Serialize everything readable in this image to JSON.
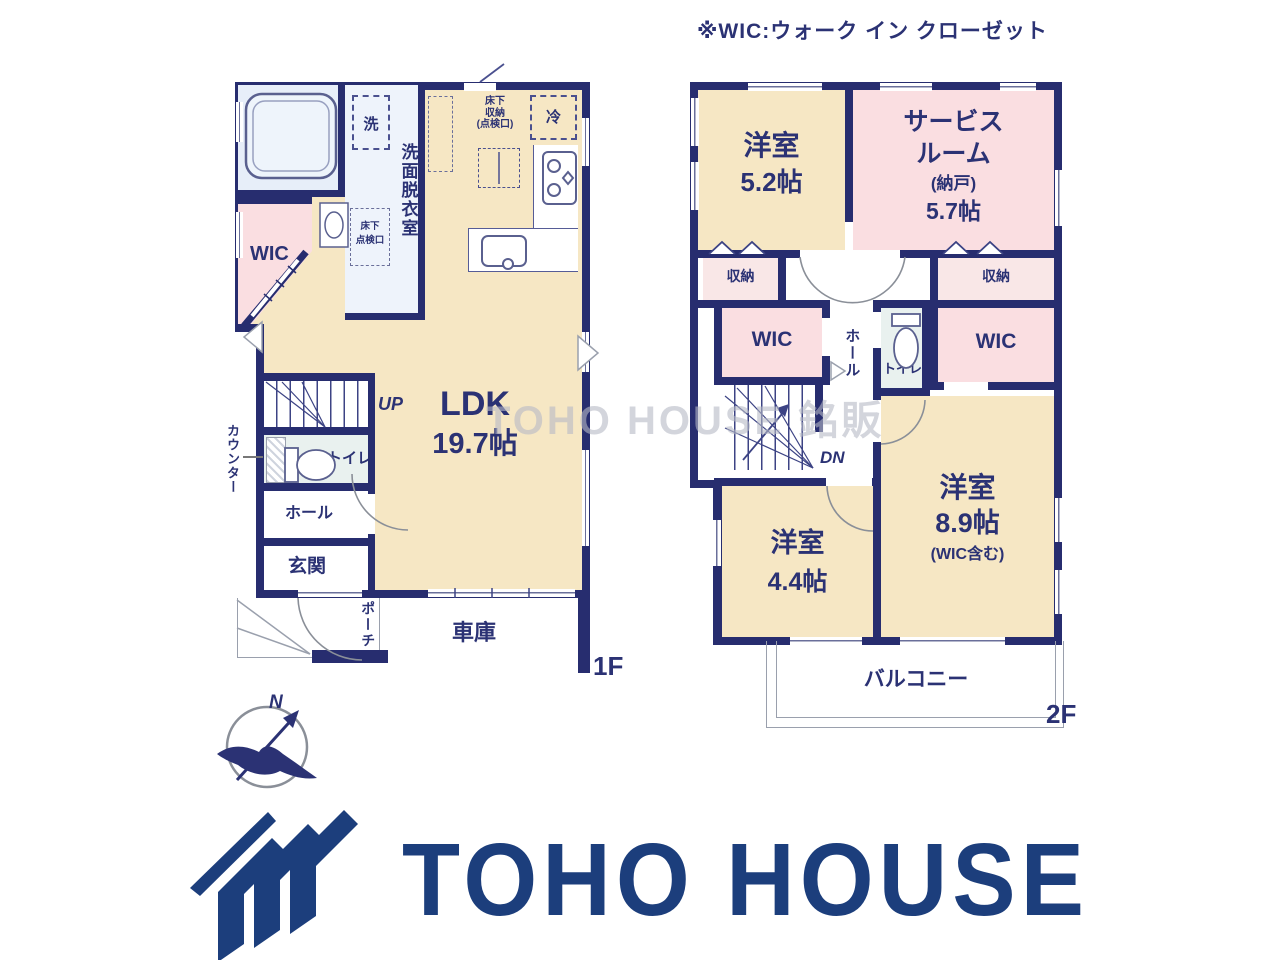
{
  "note": "※WIC:ウォーク イン クローゼット",
  "watermark": "TOHO HOUSE 銘販",
  "compass": {
    "n": "N"
  },
  "logo": {
    "text": "TOHO HOUSE"
  },
  "f1": {
    "floor": "1F",
    "ub": "UB",
    "wic": "WIC",
    "senmen": "洗面脱衣室",
    "washer": "洗",
    "tenken_a": "床下",
    "tenken_b": "点検口",
    "shuno_a": "床下",
    "shuno_b": "収納",
    "shuno_c": "(点検口)",
    "rei": "冷",
    "ldk": "LDK",
    "ldk_size": "19.7帖",
    "up": "UP",
    "toilet": "トイレ",
    "hall": "ホール",
    "genkan": "玄関",
    "porch": "ポーチ",
    "garage": "車庫",
    "counter": "カウンター"
  },
  "f2": {
    "floor": "2F",
    "room1": "洋室",
    "room1_size": "5.2帖",
    "sv1": "サービス",
    "sv2": "ルーム",
    "sv3": "(納戸)",
    "sv_size": "5.7帖",
    "st1": "収納",
    "st2": "収納",
    "wic1": "WIC",
    "wic2": "WIC",
    "hall": "ホール",
    "toilet": "トイレ",
    "dn": "DN",
    "room2": "洋室",
    "room2_size": "8.9帖",
    "room2_note": "(WIC含む)",
    "room3": "洋室",
    "room3_size": "4.4帖",
    "balcony": "バルコニー"
  },
  "colors": {
    "wall": "#272d6f",
    "ink": "#2b3274",
    "cream": "#f6e7c4",
    "pink": "#fadee1",
    "palepink": "#f9e7e7",
    "bath": "#e7eef9",
    "toiletc": "#e9f1ef",
    "logo": "#1c3e7c",
    "thin": "#8a8f98",
    "watermark": "#b7bac6"
  }
}
